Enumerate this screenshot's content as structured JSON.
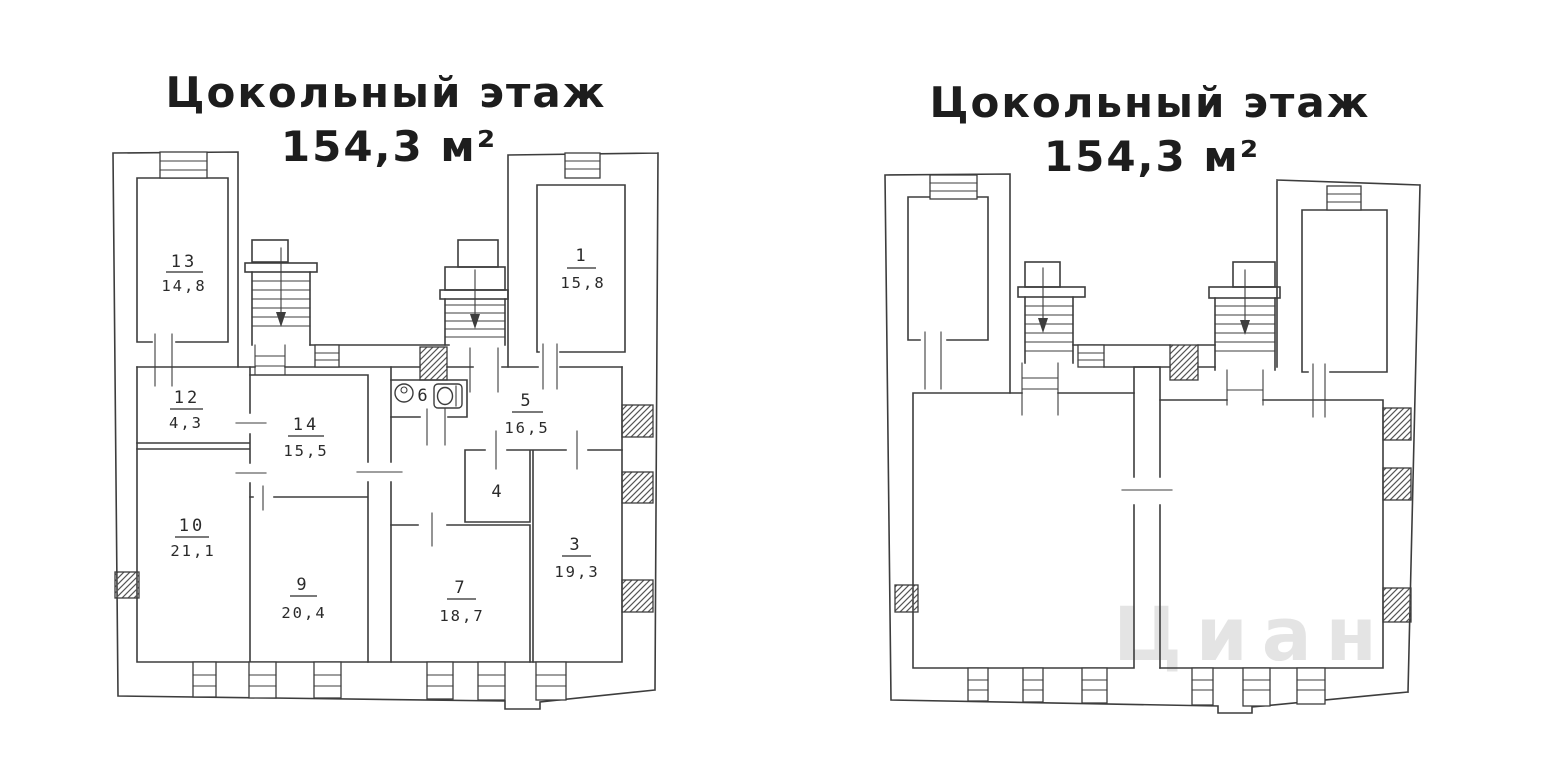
{
  "page": {
    "background": "#ffffff"
  },
  "colors": {
    "line": "#3d3d3d",
    "text": "#2a2a2a",
    "title": "#1d1d1d",
    "watermark": "#cfcfcf"
  },
  "left_plan": {
    "title": "Цокольный этаж",
    "area_label": "154,3 м²",
    "rooms": [
      {
        "number": "13",
        "area": "14,8"
      },
      {
        "number": "12",
        "area": "4,3"
      },
      {
        "number": "10",
        "area": "21,1"
      },
      {
        "number": "14",
        "area": "15,5"
      },
      {
        "number": "9",
        "area": "20,4"
      },
      {
        "number": "6"
      },
      {
        "number": "5",
        "area": "16,5"
      },
      {
        "number": "4"
      },
      {
        "number": "7",
        "area": "18,7"
      },
      {
        "number": "3",
        "area": "19,3"
      },
      {
        "number": "1",
        "area": "15,8"
      }
    ]
  },
  "right_plan": {
    "title": "Цокольный этаж",
    "area_label": "154,3 м²",
    "watermark": "Циан"
  }
}
